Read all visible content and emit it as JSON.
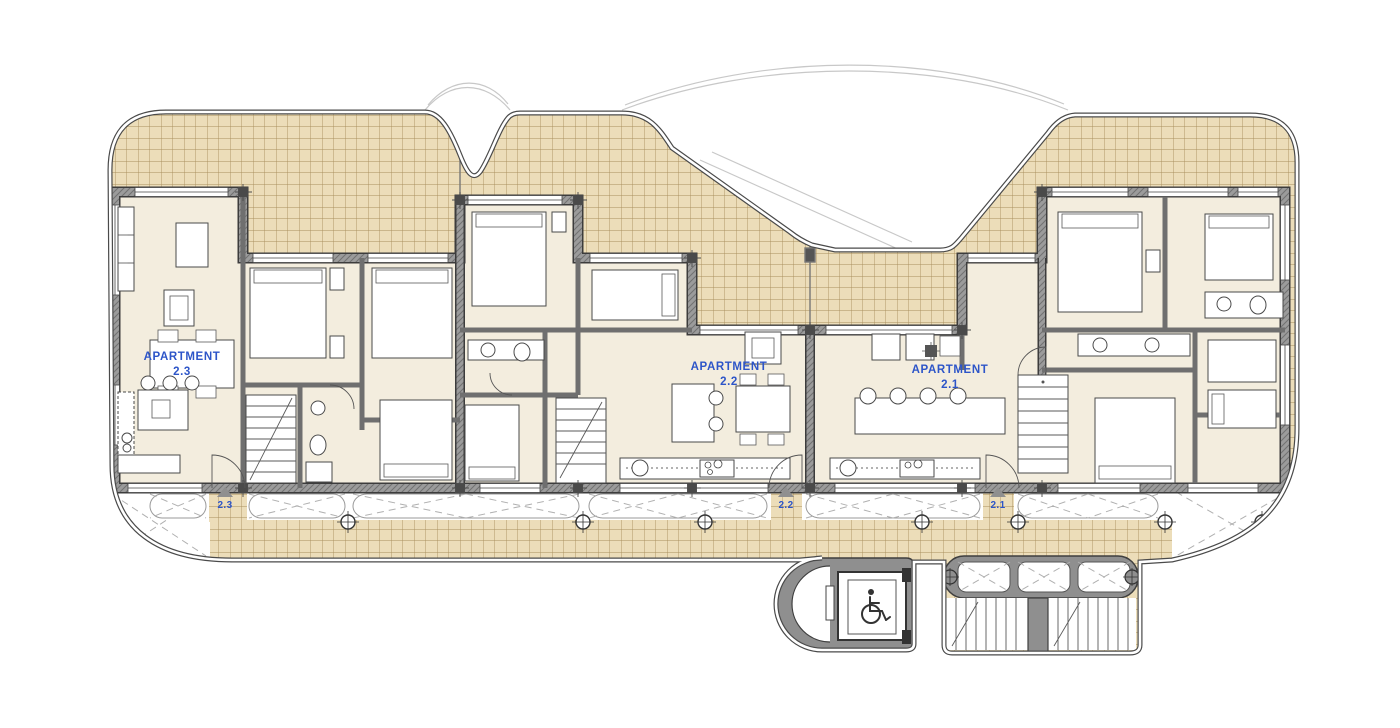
{
  "plan": {
    "type": "architectural-floor-plan",
    "apartments": [
      {
        "id": "2.3",
        "label_line1": "APARTMENT",
        "label_line2": "2.3",
        "entrance_label": "2.3"
      },
      {
        "id": "2.2",
        "label_line1": "APARTMENT",
        "label_line2": "2.2",
        "entrance_label": "2.2"
      },
      {
        "id": "2.1",
        "label_line1": "APARTMENT",
        "label_line2": "2.1",
        "entrance_label": "2.1"
      }
    ],
    "icons": {
      "elevator": "wheelchair-accessibility-icon"
    },
    "colors": {
      "background": "#ffffff",
      "terrace_tile_fill": "#ecddb9",
      "terrace_tile_line": "#a98f5d",
      "interior_floor": "#f3edde",
      "wall_gray": "#9b9b9b",
      "wall_outline": "#3c3c3c",
      "label_blue": "#2d55c8",
      "ghost_line": "#c8c8c8",
      "entrance_triangle": "#8f8f8f"
    }
  }
}
